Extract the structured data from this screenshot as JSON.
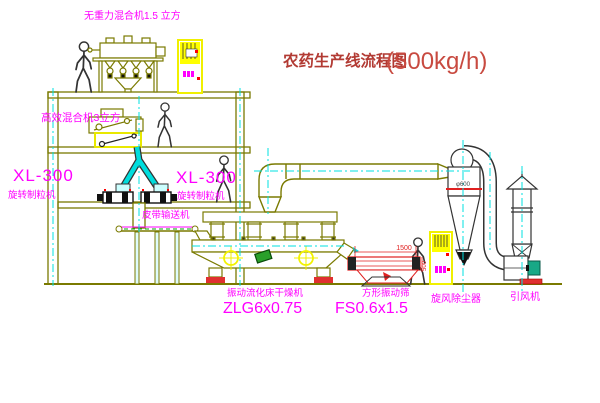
{
  "title": {
    "text": "农药生产线流程图",
    "capacity": "(500kg/h)"
  },
  "labels": {
    "gravity_mixer": "无重力混合机1.5 立方",
    "high_efficiency_mixer": "高效混合机3立方",
    "granulator_left_model": "XL-300",
    "granulator_left_name": "旋转制粒机",
    "granulator_right_model": "XL-300",
    "granulator_right_name": "旋转制粒机",
    "belt_conveyor": "皮带输送机",
    "dryer_name": "振动流化床干燥机",
    "dryer_model": "ZLG6x0.75",
    "screen_name": "方形振动筛",
    "screen_model": "FS0.6x1.5",
    "cyclone_name": "旋风除尘器",
    "fan_name": "引风机"
  },
  "dimensions": {
    "screen_width": "1500",
    "screen_height": "500",
    "cyclone_diameter": "φ600"
  },
  "colors": {
    "structure_line": "#7a7a00",
    "pipe_cyan": "#00dddd",
    "centerline_cyan": "#00e0e0",
    "label_magenta": "#ff00ff",
    "title_red": "#b23a33",
    "capacity_red": "#c84a40",
    "cabinet_yellow": "#ffff00",
    "screen_red": "#e02020",
    "alert_red": "#ff0000",
    "motor_teal": "#18a886",
    "belt_green": "#00aa00",
    "background": "#ffffff"
  }
}
